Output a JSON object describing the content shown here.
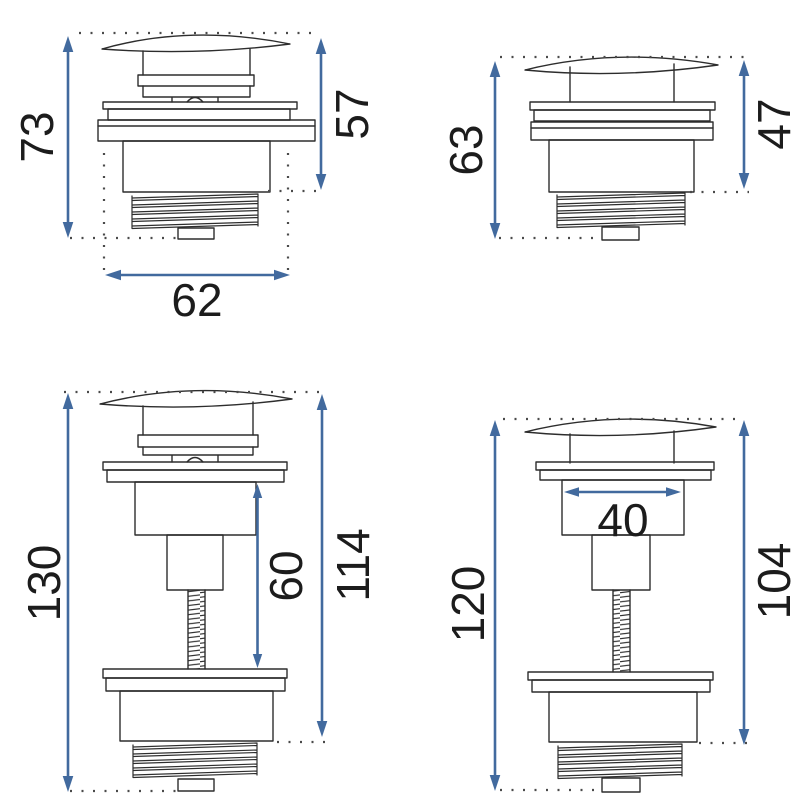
{
  "figures": [
    {
      "position": "top-left",
      "description": "pop-up drain plug, closed cap, short body",
      "dimensions": {
        "total_height": "73",
        "upper_height": "57",
        "flange_width": "62"
      }
    },
    {
      "position": "top-right",
      "description": "pop-up drain plug, closed cap, short body",
      "dimensions": {
        "total_height": "63",
        "upper_height": "47"
      }
    },
    {
      "position": "bottom-left",
      "description": "pop-up drain plug with long threaded rod",
      "dimensions": {
        "total_height": "130",
        "exposed_thread_length": "60",
        "upper_height": "114"
      }
    },
    {
      "position": "bottom-right",
      "description": "pop-up drain plug with long threaded rod",
      "dimensions": {
        "total_height": "120",
        "body_width": "40",
        "upper_height": "104"
      }
    }
  ],
  "style": {
    "dimension_color": "#426a9e",
    "outline_color": "#2d2d2d",
    "dotted_line_color": "#4a4a4a",
    "label_color": "#1c1c1c",
    "background": "#ffffff"
  }
}
